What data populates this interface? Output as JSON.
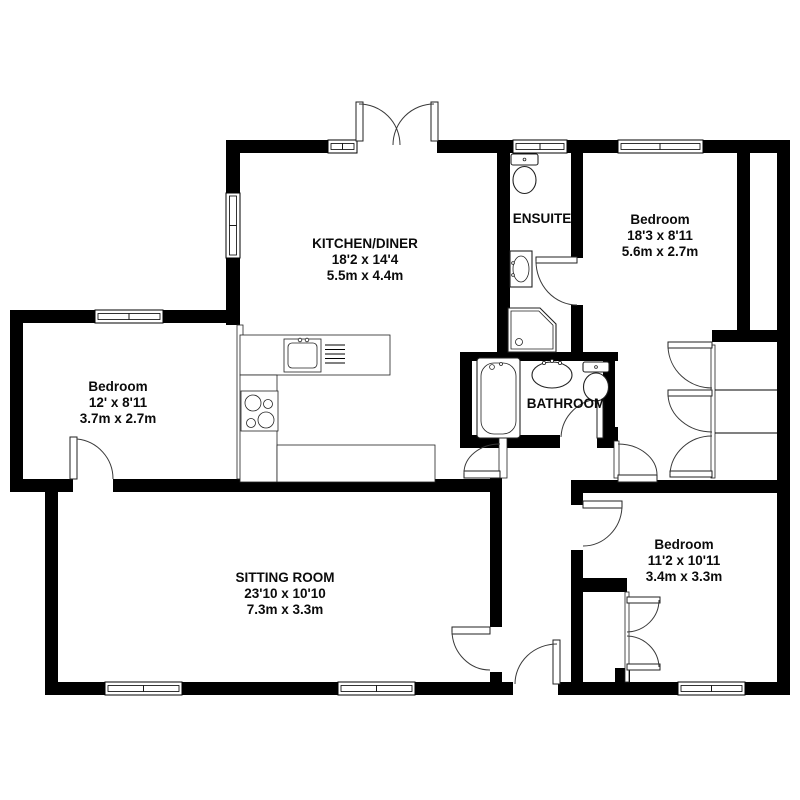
{
  "floorplan": {
    "rooms": {
      "kitchen": {
        "name": "KITCHEN/DINER",
        "imperial": "18'2 x 14'4",
        "metric": "5.5m x 4.4m"
      },
      "ensuite": {
        "name": "ENSUITE"
      },
      "bedroom1": {
        "name": "Bedroom",
        "imperial": "18'3 x 8'11",
        "metric": "5.6m x 2.7m"
      },
      "bedroom2": {
        "name": "Bedroom",
        "imperial": "12' x 8'11",
        "metric": "3.7m x 2.7m"
      },
      "bathroom": {
        "name": "BATHROOM"
      },
      "sitting": {
        "name": "SITTING ROOM",
        "imperial": "23'10 x 10'10",
        "metric": "7.3m x 3.3m"
      },
      "bedroom3": {
        "name": "Bedroom",
        "imperial": "11'2 x 10'11",
        "metric": "3.4m x 3.3m"
      }
    },
    "colors": {
      "wall": "#000000",
      "floor": "#ffffff",
      "line": "#3a3a3a"
    }
  }
}
